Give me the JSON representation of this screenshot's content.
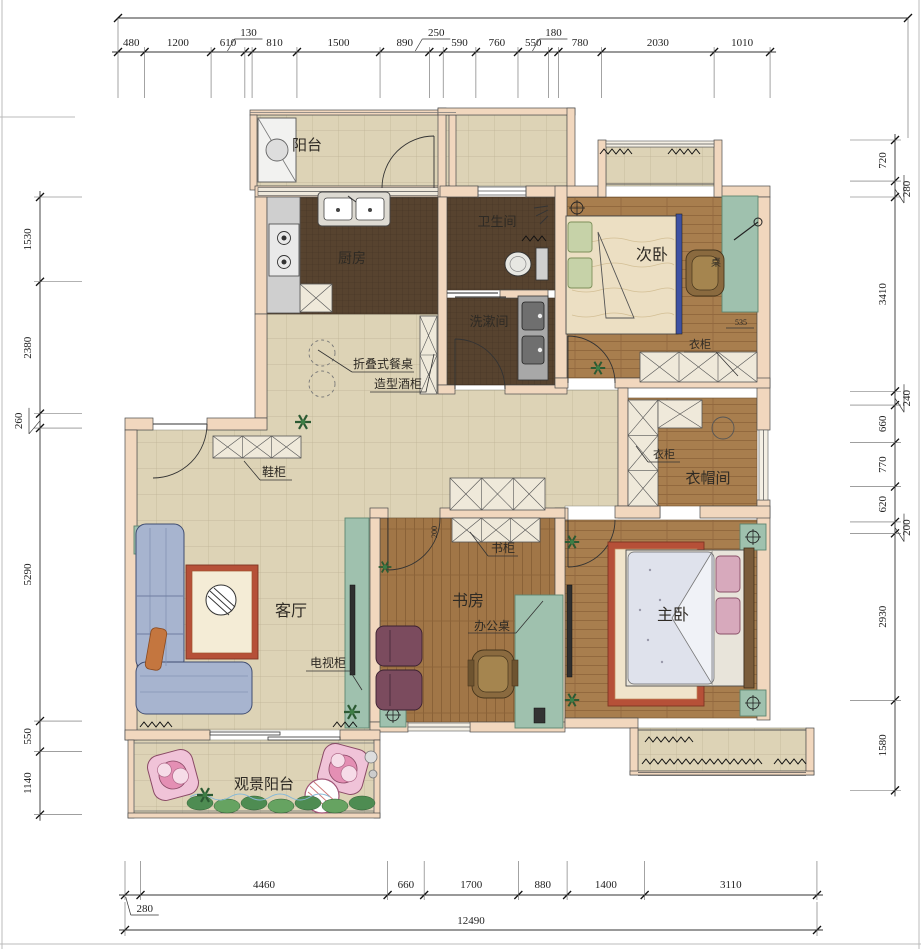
{
  "title": "residential floor plan",
  "colors": {
    "wall": "#f1d7be",
    "wall_stroke": "#4a4a4a",
    "tile": "#ddd3b6",
    "tile_line": "#bdb295",
    "wood": "#a87e4e",
    "wood_line": "#8a6238",
    "mosaic": "#57432f",
    "green_cabinet": "#9fc1ae",
    "cabinet_x_fill": "#efe9da",
    "rug_border": "#b65038",
    "sofa_blue": "#a7b4cf",
    "pink_chair": "#f0c3d8",
    "dim_line": "#333333"
  },
  "labels": {
    "balcony": "阳台",
    "kitchen": "厨房",
    "bathroom": "卫生间",
    "washroom": "洗漱间",
    "bedroom2": "次卧",
    "wardrobe_a": "衣柜",
    "wardrobe_b": "衣柜",
    "desk_note": "桌",
    "cloakroom": "衣帽间",
    "living": "客厅",
    "tv_cabinet": "电视柜",
    "shoe_cabinet": "鞋柜",
    "folding_table": "折叠式餐桌",
    "wine_cabinet": "造型酒柜",
    "study": "书房",
    "bookcase": "书柜",
    "office_desk": "办公桌",
    "master": "主卧",
    "view_balcony": "观景阳台",
    "d535": "535",
    "d200": "200"
  },
  "dimensions": {
    "top": {
      "segments": [
        {
          "v": "480"
        },
        {
          "v": "1200"
        },
        {
          "v": "610"
        },
        {
          "v": "130",
          "off": 1
        },
        {
          "v": "810"
        },
        {
          "v": "1500"
        },
        {
          "v": "890"
        },
        {
          "v": "250",
          "off": 1
        },
        {
          "v": "590"
        },
        {
          "v": "760"
        },
        {
          "v": "550"
        },
        {
          "v": "180",
          "off": 1
        },
        {
          "v": "780"
        },
        {
          "v": "2030"
        },
        {
          "v": "1010"
        }
      ]
    },
    "left": {
      "segments": [
        {
          "v": "1530"
        },
        {
          "v": "2380"
        },
        {
          "v": "260",
          "off": 1
        },
        {
          "v": "5290"
        },
        {
          "v": "550"
        },
        {
          "v": "1140"
        }
      ]
    },
    "right": {
      "segments": [
        {
          "v": "720"
        },
        {
          "v": "280",
          "off": 1
        },
        {
          "v": "3410"
        },
        {
          "v": "240",
          "off": 1
        },
        {
          "v": "660"
        },
        {
          "v": "770"
        },
        {
          "v": "620"
        },
        {
          "v": "200",
          "off": 1
        },
        {
          "v": "2930"
        },
        {
          "v": "1580"
        }
      ]
    },
    "bottom": {
      "segments": [
        {
          "v": "280",
          "off": 1
        },
        {
          "v": "4460"
        },
        {
          "v": "660"
        },
        {
          "v": "1700"
        },
        {
          "v": "880"
        },
        {
          "v": "1400"
        },
        {
          "v": "3110"
        }
      ]
    },
    "overall": "12490"
  }
}
